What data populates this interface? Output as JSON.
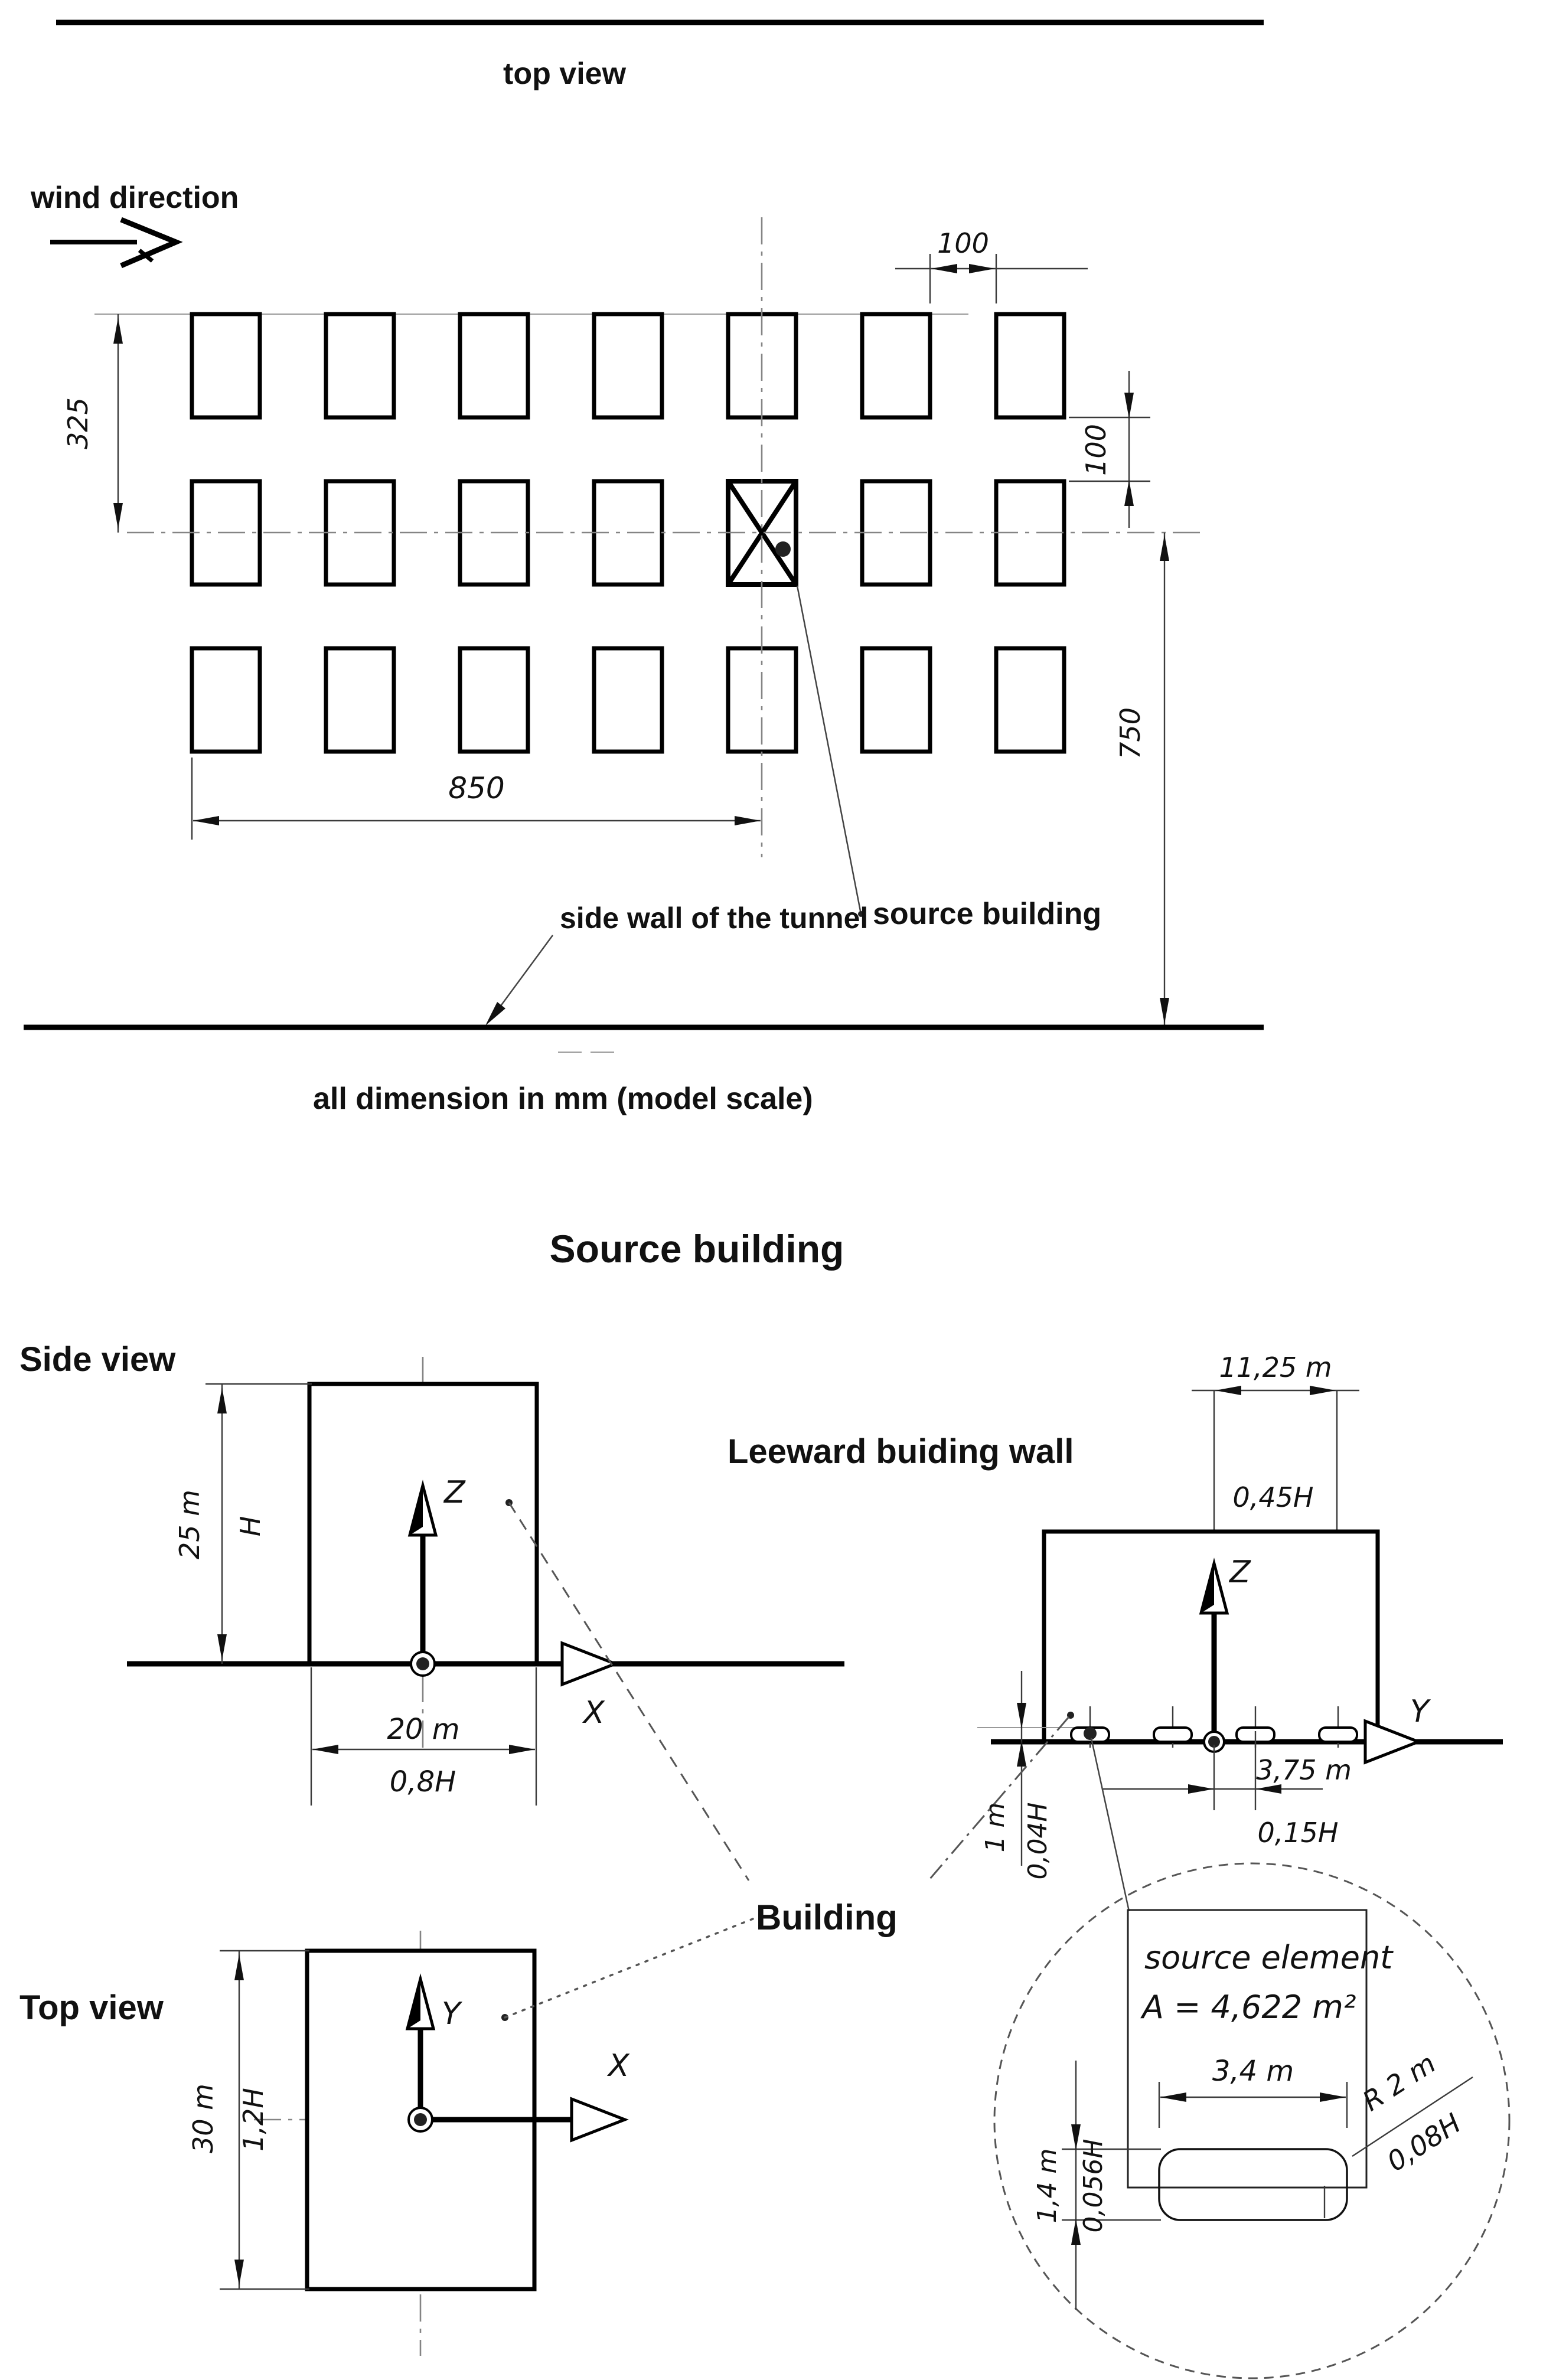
{
  "plan": {
    "title": "top view",
    "wind_label": "wind direction",
    "dim_row_pitch": "325",
    "dim_col_gap": "100",
    "dim_row_gap": "100",
    "dim_to_centerline": "850",
    "dim_to_wall": "750",
    "source_building_label": "source building",
    "side_wall_label": "side wall of the tunnel",
    "units_note": "all dimension in mm (model scale)"
  },
  "section_title": "Source building",
  "side_view": {
    "heading": "Side view",
    "height_m": "25 m",
    "height_h": "H",
    "width_m": "20 m",
    "width_h": "0,8H",
    "axis_z": "Z",
    "axis_x": "X"
  },
  "leeward": {
    "heading": "Leeward buiding wall",
    "offset_m": "11,25 m",
    "offset_h": "0,45H",
    "spacing_m": "3,75 m",
    "spacing_h": "0,15H",
    "elem_h_m": "1 m",
    "elem_h_h": "0,04H",
    "axis_z": "Z",
    "axis_y": "Y"
  },
  "top_view": {
    "heading": "Top view",
    "depth_m": "30 m",
    "depth_h": "1,2H",
    "axis_y": "Y",
    "axis_x": "X"
  },
  "building_label": "Building",
  "detail": {
    "name": "source element",
    "area": "A = 4,622 m²",
    "width_m": "3,4 m",
    "radius_m": "R 2 m",
    "radius_h": "0,08H",
    "height_m": "1,4 m",
    "height_h": "0,056H"
  }
}
